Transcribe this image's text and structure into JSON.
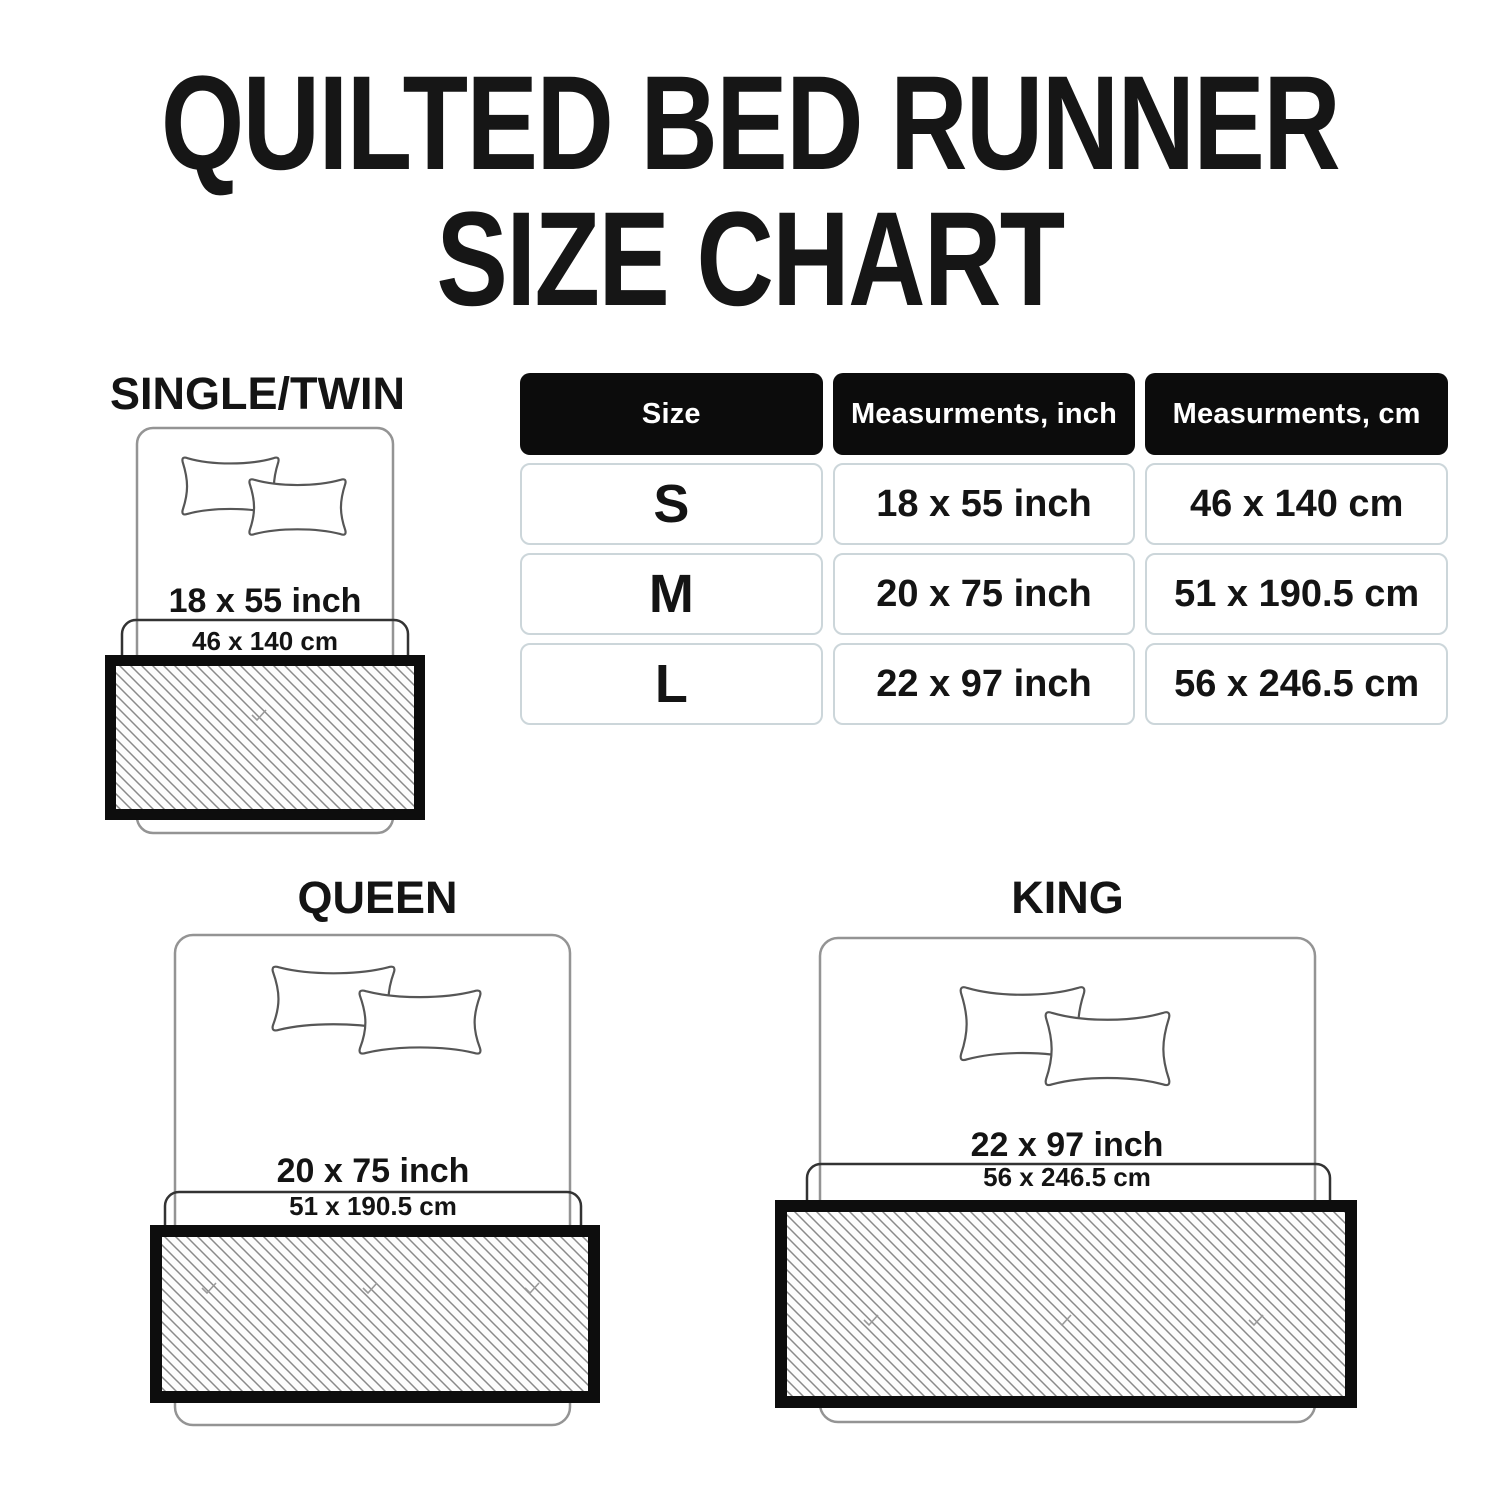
{
  "title": {
    "line1": "QUILTED BED RUNNER",
    "line2": "SIZE CHART"
  },
  "size_table": {
    "headers": {
      "size": "Size",
      "inch": "Measurments, inch",
      "cm": "Measurments, cm"
    },
    "rows": [
      {
        "size": "S",
        "inch": "18 x 55 inch",
        "cm": "46 x 140 cm"
      },
      {
        "size": "M",
        "inch": "20 x 75 inch",
        "cm": "51 x 190.5 cm"
      },
      {
        "size": "L",
        "inch": "22 x 97 inch",
        "cm": "56 x 246.5 cm"
      }
    ]
  },
  "diagrams": {
    "single_twin": {
      "label": "SINGLE/TWIN",
      "inch": "18 x 55 inch",
      "cm": "46 x 140 cm"
    },
    "queen": {
      "label": "QUEEN",
      "inch": "20 x 75 inch",
      "cm": "51 x 190.5 cm"
    },
    "king": {
      "label": "KING",
      "inch": "22 x 97 inch",
      "cm": "56 x 246.5 cm"
    }
  },
  "colors": {
    "background": "#ffffff",
    "text": "#141414",
    "table_header_bg": "#0c0c0c",
    "table_header_text": "#ffffff",
    "table_cell_border": "#ccd6da",
    "bed_outline": "#949494",
    "pillow_outline": "#565656",
    "cm_box_outline": "#333333",
    "runner_border": "#0d0d0d",
    "hatch_line": "#8a8a8a"
  }
}
